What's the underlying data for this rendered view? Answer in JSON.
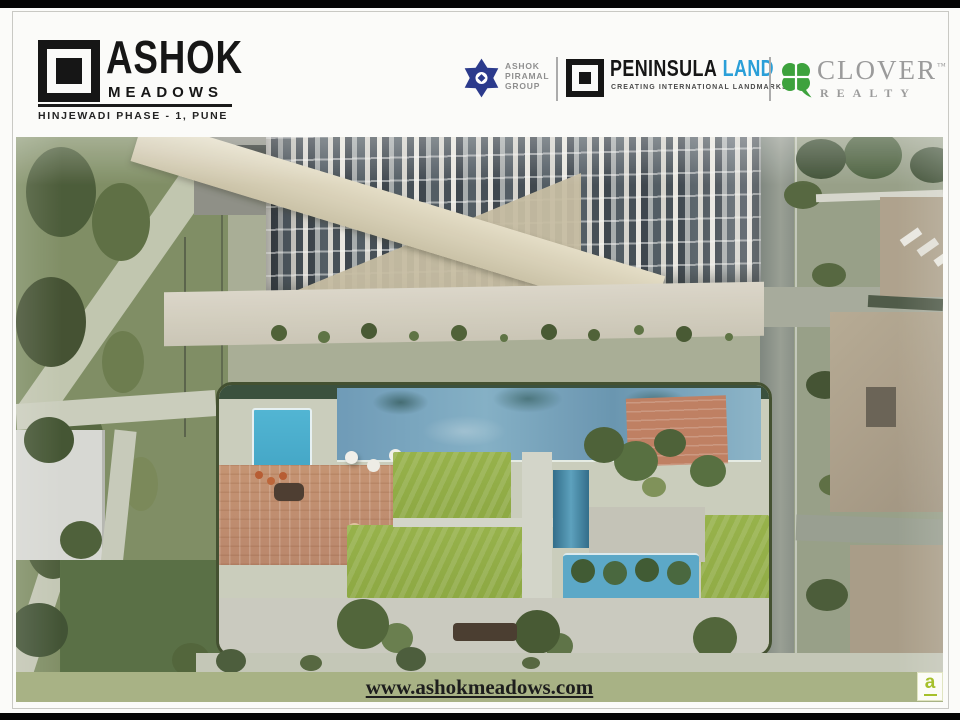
{
  "brand": {
    "line1": "ASHOK",
    "line2": "MEADOWS",
    "location": "HINJEWADI PHASE - 1, PUNE",
    "logo_color": "#161616"
  },
  "partners": {
    "apg": {
      "line1": "ASHOK",
      "line2": "PIRAMAL",
      "line3": "GROUP",
      "icon_color": "#2b3a8c"
    },
    "peninsula": {
      "name": "PENINSULA",
      "land": "LAND",
      "land_color": "#2a9fd8",
      "tagline": "CREATING INTERNATIONAL LANDMARKS",
      "icon_color": "#161616"
    },
    "clover": {
      "name": "CLOVER",
      "tm": "™",
      "realty": "REALTY",
      "icon_color": "#3da23d",
      "text_color": "#9b9b9b"
    }
  },
  "photo": {
    "alt": "Aerial 3D render of Ashok Meadows residential complex: high-rise apartment tower, swimming pools, sun deck with umbrellas, lawns, landscaped walkways and neighbouring rooftops"
  },
  "footer": {
    "url": "www.ashokmeadows.com",
    "band_color": "#a8b285"
  },
  "watermark": {
    "letter": "a",
    "color": "#a6c02c"
  }
}
